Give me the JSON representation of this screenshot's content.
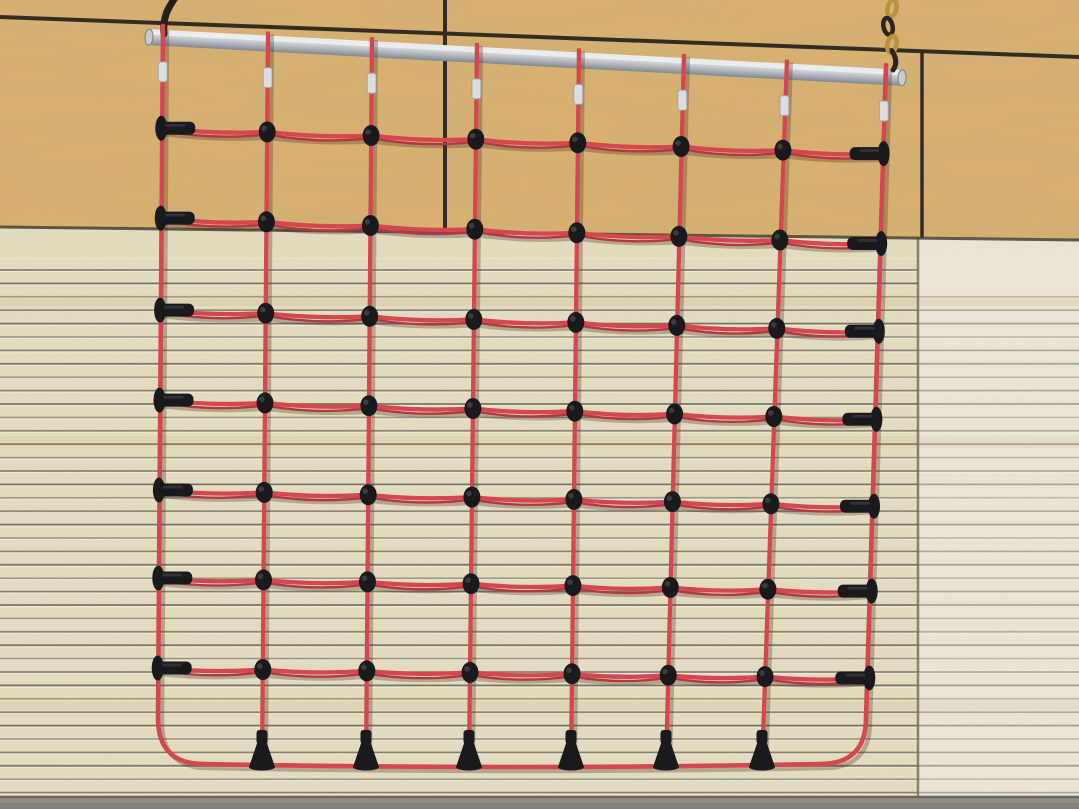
{
  "description": "Photograph of a red rope climbing cargo net hanging from a silver metal bar against a gym wall. Upper wall is plywood panels with dark seams; lower wall is a cream slatted acoustic panel with horizontal grooves. The net has 8 vertical ropes and 7 horizontal rope rows joined by black plastic connectors, black T-shaped end caps on the left and right edges, black trumpet-shaped caps along the bottom rope, and silver crimp sleeves below the bar. The bar hangs from a dark hook at the top left and a yellow-and-black chain at the top right.",
  "scene": {
    "width": 1079,
    "height": 809
  },
  "palette": {
    "plywood": "#d9b273",
    "plywoodGrain": "#9c7440",
    "seam": "#332c22",
    "boundary": "#4a4336",
    "slatLeft": "#e4dcc0",
    "slatRight": "#eae5d4",
    "groove": "#6e6a5a",
    "grooveHi": "#fffef2",
    "tintBand": "#c99f6e",
    "floor": "#928e85",
    "floorEdge": "#6b675e",
    "floorLow": "#7f7c73",
    "barHi": "#eef0f1",
    "barMid": "#b5bac0",
    "barLow": "#82888f",
    "barEnd": "#c9ccce",
    "rope": "#d4474f",
    "ropeDark": "#b23843",
    "ropeShadow": "rgba(80,52,36,0.32)",
    "black": "#1a191c",
    "blackHi": "#4a4a52",
    "sleeve": "#dcdddd",
    "sleeveEdge": "#9da0a2",
    "hook": "#23211d",
    "chainYellow": "#b3953c",
    "chainDark": "#2a261f"
  },
  "wall": {
    "horizontal_seam": {
      "y_left": 17,
      "y_right": 57
    },
    "plywood_bottom": {
      "y_left": 227,
      "y_right": 240
    },
    "vertical_seam_left_x": 445,
    "vertical_seam_right_x": 922,
    "slat_seam_x": 918,
    "groove_start_left_y": 258,
    "groove_start_right_y": 286,
    "floor_y": 796
  },
  "bar": {
    "x1": 146,
    "y1": 37,
    "x2": 905,
    "y2": 78,
    "thickness": 16
  },
  "hangers": {
    "left_hook": {
      "top_x": 179,
      "top_y": -8,
      "attach_x": 164,
      "attach_y": 34
    },
    "right_chain": {
      "x": 890,
      "link_ys": [
        8,
        26,
        44
      ],
      "attach_x": 893,
      "attach_y": 70
    }
  },
  "net": {
    "columns_count": 8,
    "rows_count": 7,
    "edge_left_x": 158,
    "edge_right_x": 866,
    "columns": [
      {
        "x_top": 163,
        "x_bottom": 158
      },
      {
        "x_top": 268,
        "x_bottom": 262
      },
      {
        "x_top": 372,
        "x_bottom": 366
      },
      {
        "x_top": 477,
        "x_bottom": 469
      },
      {
        "x_top": 579,
        "x_bottom": 571
      },
      {
        "x_top": 684,
        "x_bottom": 666
      },
      {
        "x_top": 787,
        "x_bottom": 762
      },
      {
        "x_top": 886,
        "x_bottom": 866
      }
    ],
    "rows": [
      {
        "y_left": 128,
        "y_right": 153
      },
      {
        "y_left": 218,
        "y_right": 243
      },
      {
        "y_left": 310,
        "y_right": 331
      },
      {
        "y_left": 400,
        "y_right": 419
      },
      {
        "y_left": 490,
        "y_right": 506
      },
      {
        "y_left": 578,
        "y_right": 591
      },
      {
        "y_left": 668,
        "y_right": 678
      }
    ],
    "bottom_y": 764,
    "corner_radius": 46,
    "row_sag": 4.5,
    "bottom_sag": 6,
    "sleeve_offset": 34
  }
}
